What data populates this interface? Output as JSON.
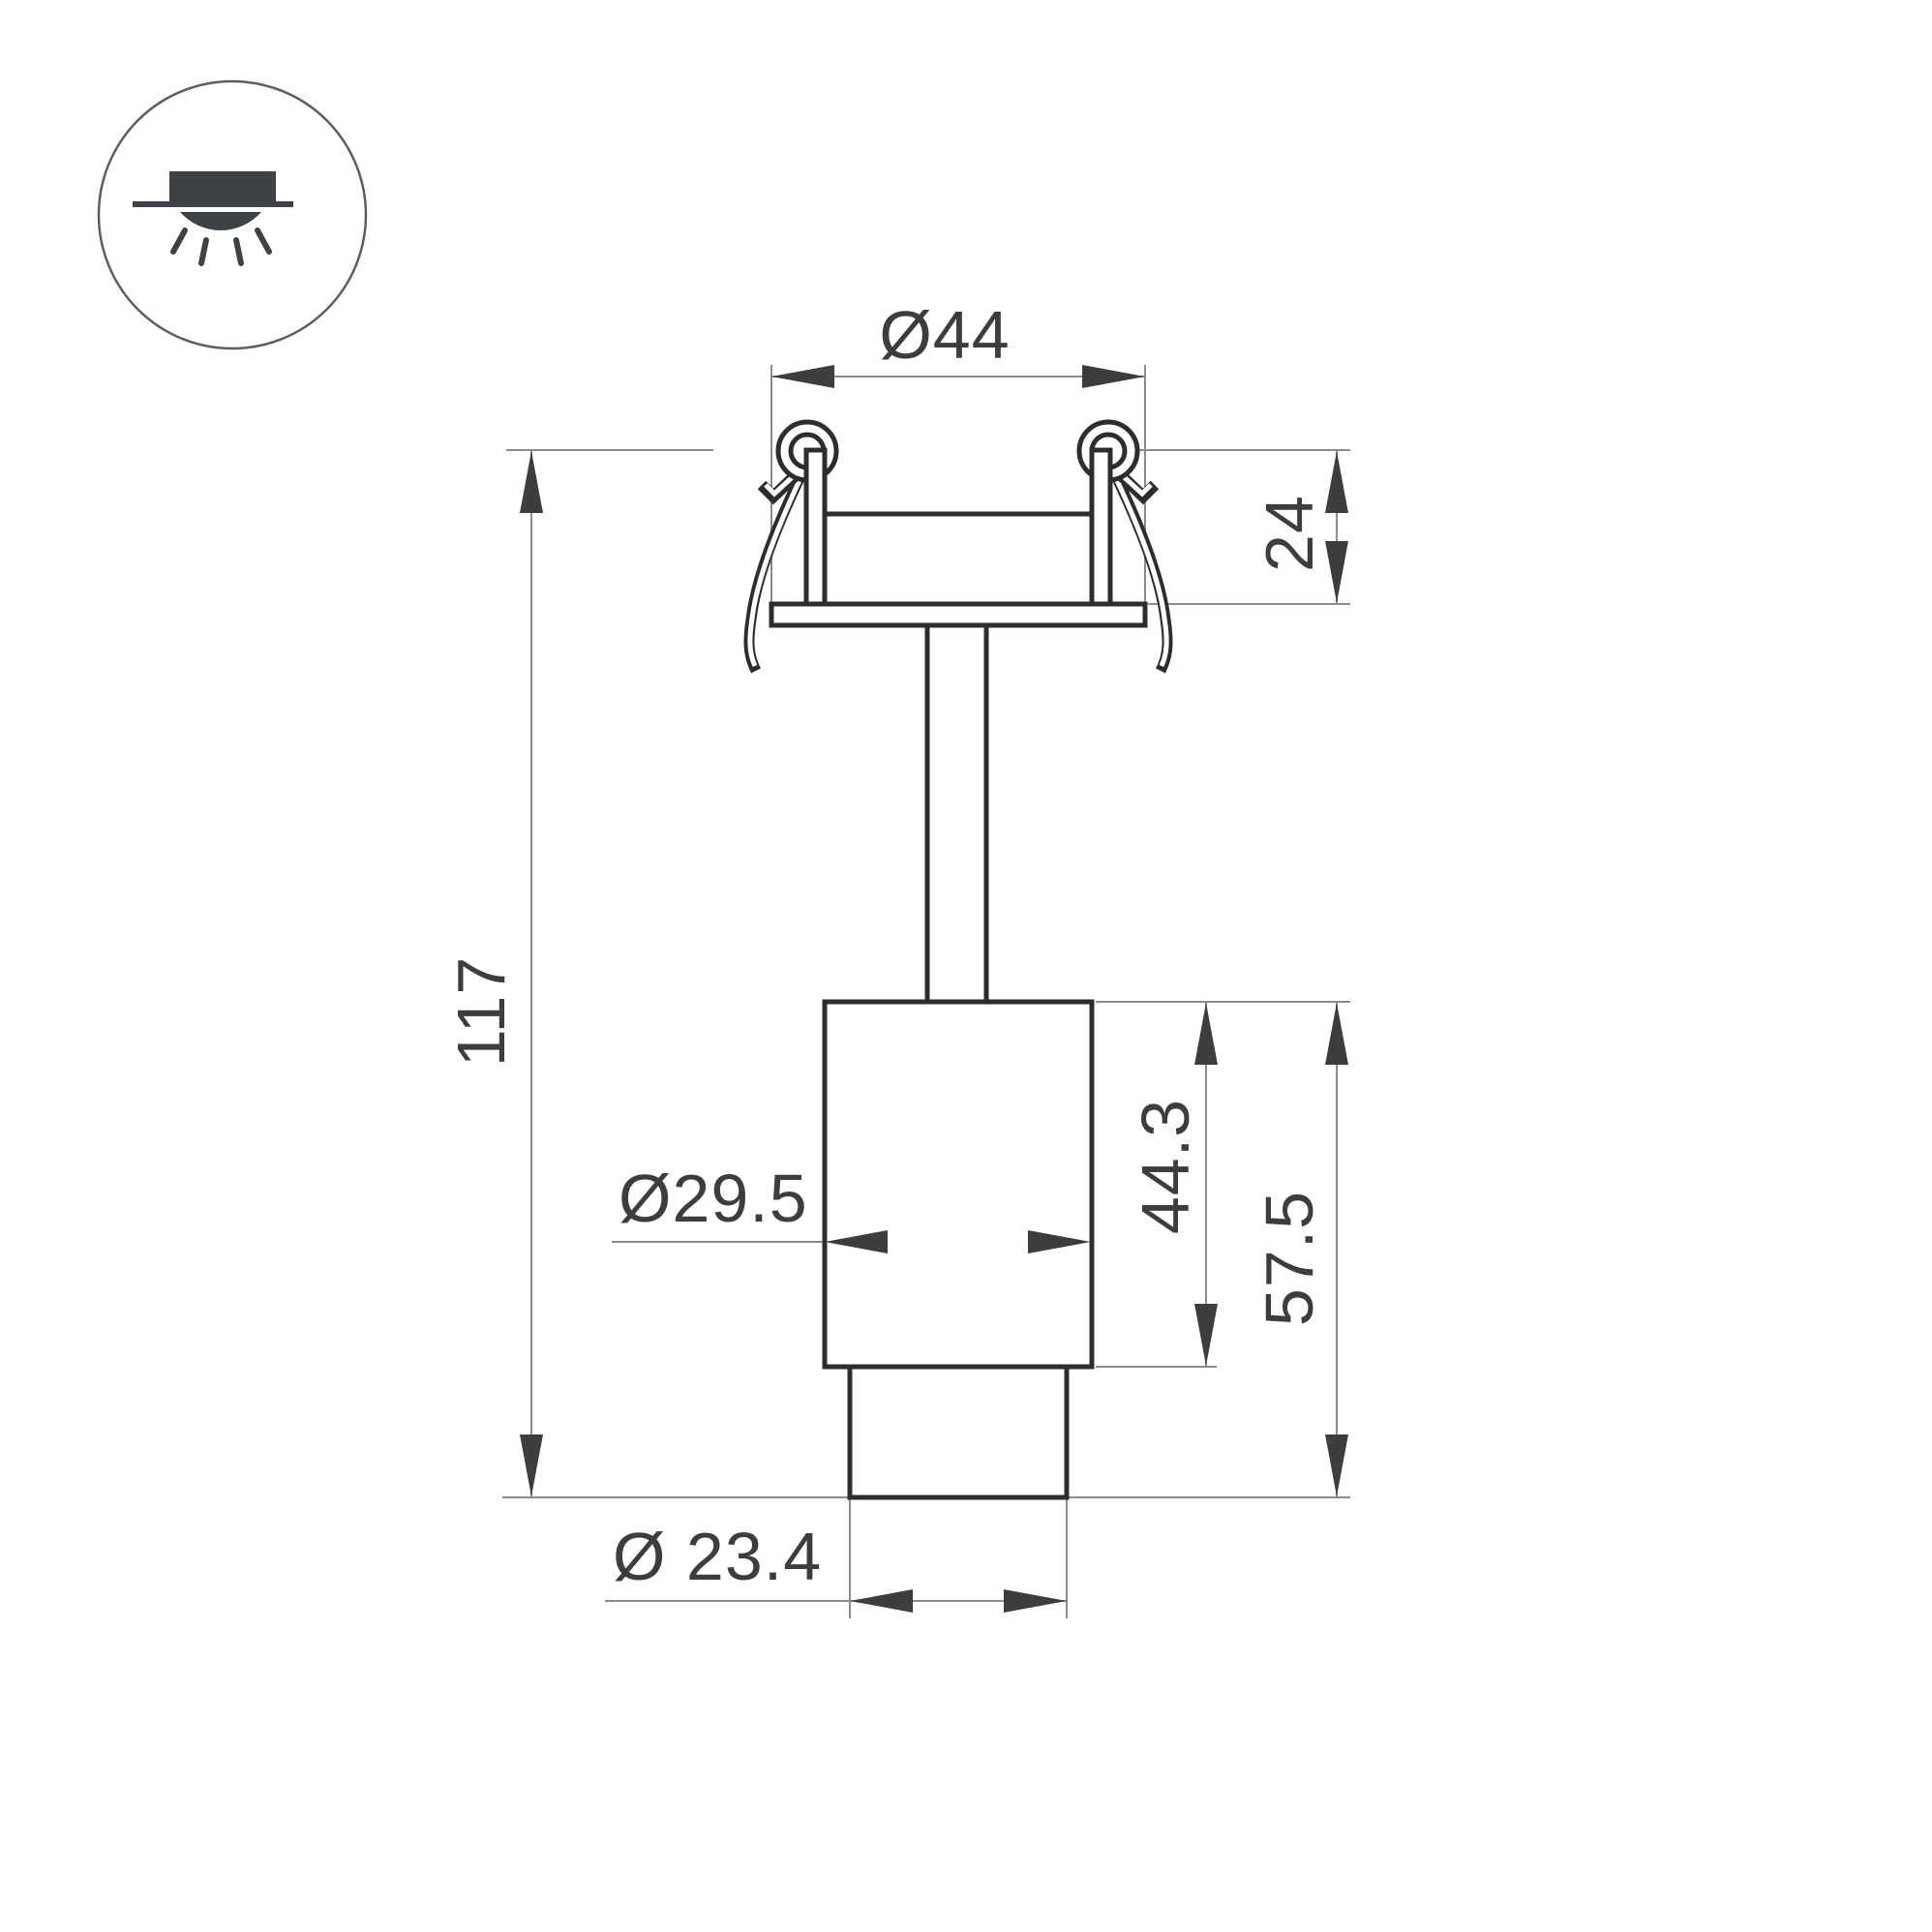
{
  "icon": {
    "name": "recessed-downlight-icon",
    "description": "circle badge with recessed fixture above ceiling line and light rays below"
  },
  "drawing": {
    "type": "technical-dimension-drawing",
    "subject": "recessed spotlight with spring clips, side elevation"
  },
  "dimensions": {
    "top_diameter": "Ø44",
    "recess_depth": "24",
    "total_height": "117",
    "body_diameter": "Ø29.5",
    "body_height": "44.3",
    "lower_height": "57.5",
    "tip_diameter": "Ø 23.4"
  },
  "colors": {
    "background": "#ffffff",
    "outline": "#2d2d2d",
    "dimension_line": "#8c8c8c",
    "dimension_text": "#3d3d3d",
    "icon_ink": "#3e4145",
    "icon_ring": "#5a5e62"
  }
}
